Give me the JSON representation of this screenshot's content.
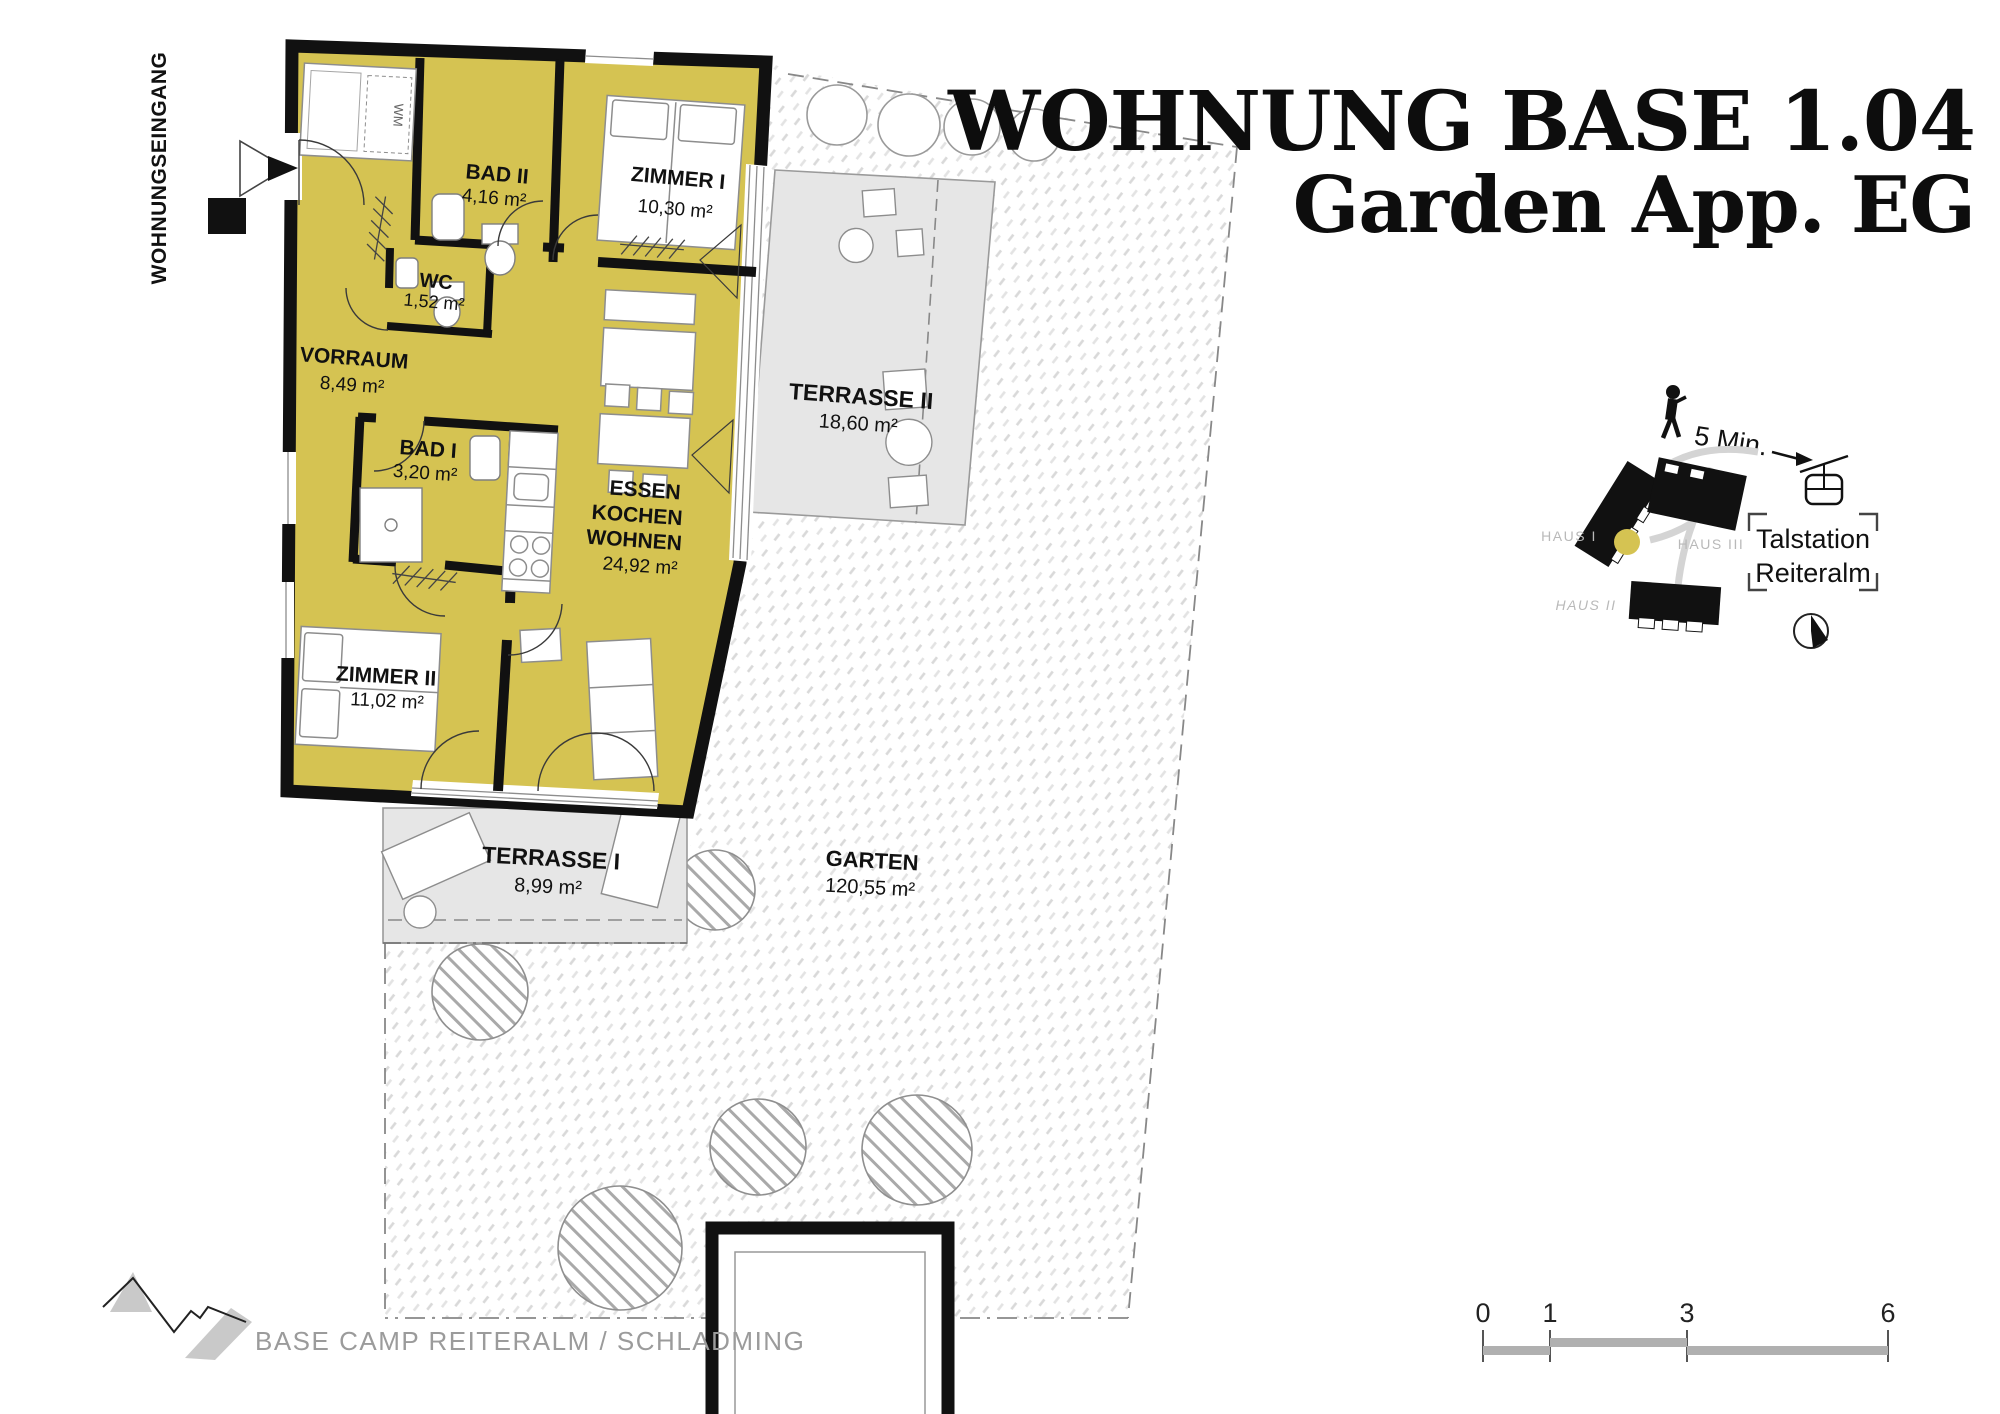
{
  "title": {
    "line1": "WOHNUNG BASE 1.04",
    "line2": "Garden App. EG"
  },
  "entrance": {
    "label": "WOHNUNGSEINGANG"
  },
  "plan": {
    "bad2": {
      "name": "BAD II",
      "area": "4,16 m²"
    },
    "zimmer1": {
      "name": "ZIMMER I",
      "area": "10,30 m²"
    },
    "wc": {
      "name": "WC",
      "area": "1,52 m²"
    },
    "vorraum": {
      "name": "VORRAUM",
      "area": "8,49 m²"
    },
    "bad1": {
      "name": "BAD I",
      "area": "3,20 m²"
    },
    "living": {
      "name_line1": "ESSEN",
      "name_line2": "KOCHEN",
      "name_line3": "WOHNEN",
      "area": "24,92 m²"
    },
    "zimmer2": {
      "name": "ZIMMER II",
      "area": "11,02 m²"
    },
    "terrasse2": {
      "name": "TERRASSE II",
      "area": "18,60 m²"
    },
    "terrasse1": {
      "name": "TERRASSE I",
      "area": "8,99 m²"
    },
    "garten": {
      "name": "GARTEN",
      "area": "120,55 m²"
    },
    "washer_label": "WM"
  },
  "site_inset": {
    "walk_time": "5 Min.",
    "haus1": "HAUS I",
    "haus2": "HAUS II",
    "haus3": "HAUS III",
    "station_line1": "Talstation",
    "station_line2": "Reiteralm"
  },
  "scale_bar": {
    "tick0": "0",
    "tick1": "1",
    "tick3": "3",
    "tick6": "6"
  },
  "footer": {
    "project_label": "BASE CAMP REITERALM / SCHLADMING"
  },
  "colors": {
    "room_fill": "#d5c352",
    "terrace_fill": "#e6e6e6",
    "wall": "#000000",
    "marker_yellow": "#d5c352"
  }
}
